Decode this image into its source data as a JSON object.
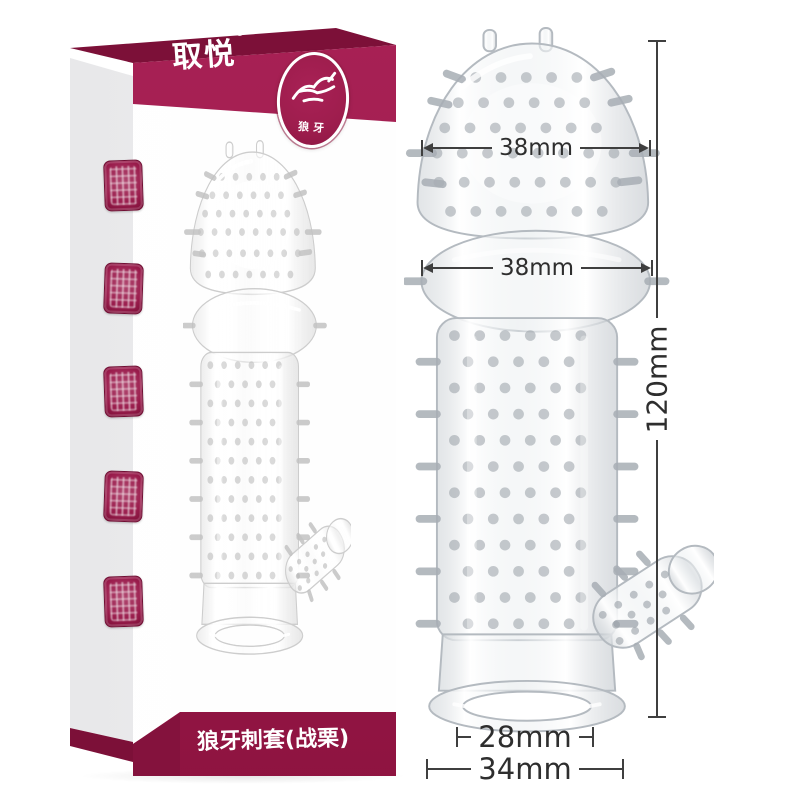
{
  "packaging": {
    "brand_logo": "取悦",
    "registered_mark": "®",
    "badge_label": "狼牙",
    "product_name": "狼牙刺套(战栗)",
    "seal_count": 5
  },
  "annotations": {
    "head_width": "38mm",
    "bulb_width": "38mm",
    "total_length": "120mm",
    "inner_diameter": "28mm",
    "outer_diameter": "34mm"
  },
  "colors": {
    "banner_red": "#9e1d4d",
    "banner_dark_red": "#7c1038",
    "dimension_line": "#3f3f3f",
    "dimension_text": "#2e2e2e",
    "background": "#ffffff"
  },
  "icons": {
    "badge_icon": "wolf-sketch-icon",
    "seal_icon": "seal-stamp-icon"
  }
}
